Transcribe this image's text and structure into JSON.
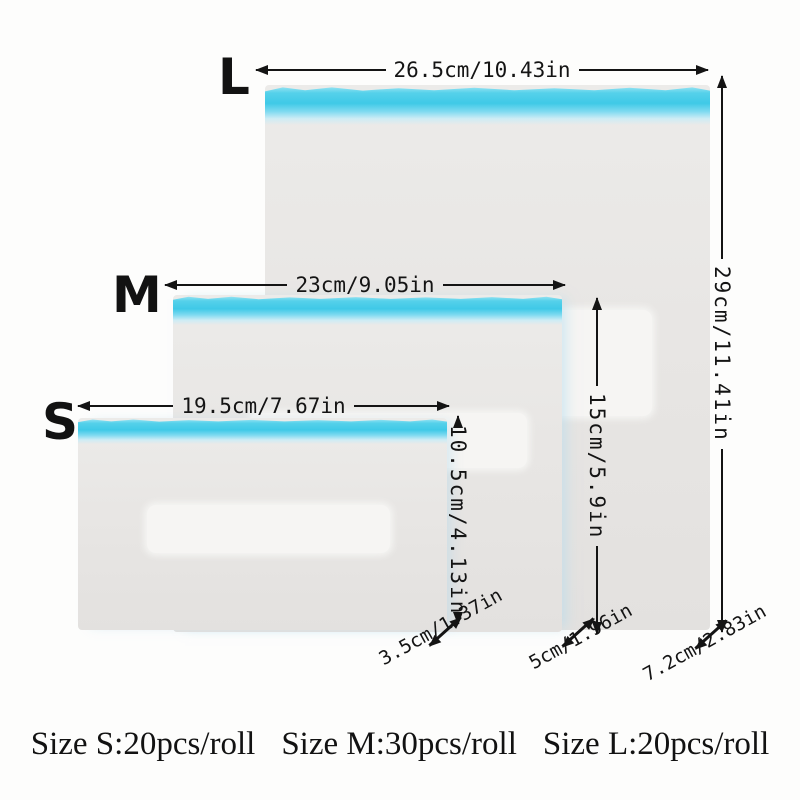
{
  "bags": {
    "l": {
      "letter": "L",
      "width": "26.5cm/10.43in",
      "height": "29cm/11.41in",
      "depth": "7.2cm/2.83in"
    },
    "m": {
      "letter": "M",
      "width": "23cm/9.05in",
      "height": "15cm/5.9in",
      "depth": "5cm/1.96in"
    },
    "s": {
      "letter": "S",
      "width": "19.5cm/7.67in",
      "height": "10.5cm/4.13in",
      "depth": "3.5cm/1.37in"
    }
  },
  "caption": {
    "size_s": "Size S:20pcs/roll",
    "size_m": "Size M:30pcs/roll",
    "size_l": "Size L:20pcs/roll"
  },
  "colors": {
    "zipper_cyan": "#3fc9e7",
    "bag_body": "#e8e6e4",
    "ink": "#141414",
    "background": "#fdfdfc"
  }
}
